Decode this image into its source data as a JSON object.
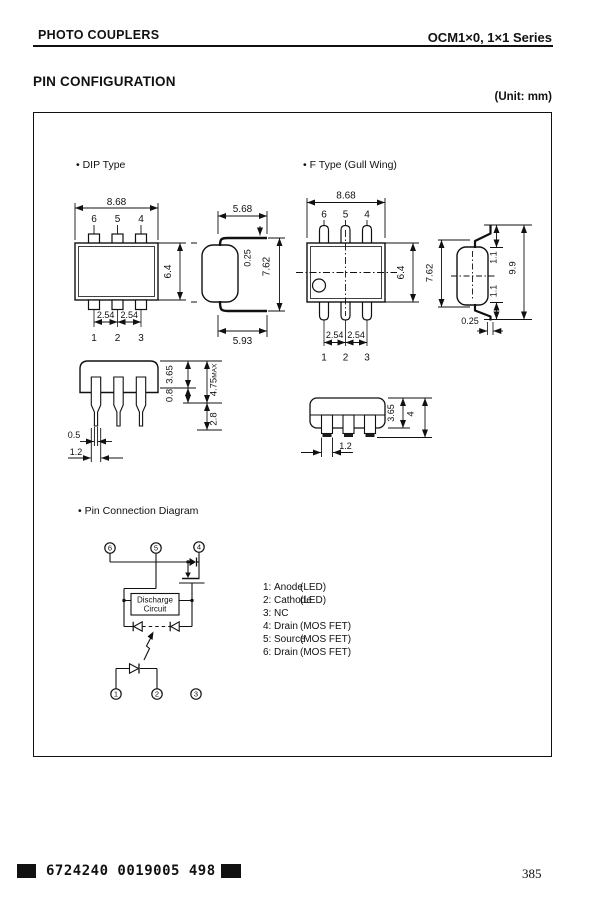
{
  "header": {
    "left": "PHOTO COUPLERS",
    "right": "OCM1×0, 1×1 Series"
  },
  "title": "PIN CONFIGURATION",
  "unit_label": "(Unit: mm)",
  "sections": {
    "dip": "• DIP Type",
    "ftype": "• F Type (Gull Wing)",
    "pin_diagram": "• Pin Connection Diagram"
  },
  "dip": {
    "top": {
      "width": "8.68",
      "height": "6.4",
      "pitch_left": "2.54",
      "pitch_right": "2.54",
      "pins_top": [
        "6",
        "5",
        "4"
      ],
      "pins_bottom": [
        "1",
        "2",
        "3"
      ]
    },
    "side": {
      "top_width": "5.68",
      "lead_thickness": "0.25",
      "height": "7.62",
      "bottom_width": "5.93"
    },
    "front": {
      "body_height": "3.65",
      "shoulder": "0.8",
      "overall": "4.75",
      "overall_suffix": "MAX",
      "lead_length": "2.8",
      "lead_width": "0.5",
      "lead_base_width": "1.2"
    }
  },
  "ftype": {
    "top": {
      "width": "8.68",
      "height": "6.4",
      "pitch_left": "2.54",
      "pitch_right": "2.54",
      "pins_top": [
        "6",
        "5",
        "4"
      ],
      "pins_bottom": [
        "1",
        "2",
        "3"
      ]
    },
    "side": {
      "body_height": "7.62",
      "lead_top": "1.1",
      "lead_bottom": "1.1",
      "overall": "9.9",
      "lead_thickness": "0.25"
    },
    "front": {
      "body_height": "3.65",
      "overall": "4",
      "lead_width": "1.2"
    }
  },
  "diagram": {
    "pins_top": [
      "6",
      "5",
      "4"
    ],
    "pins_bottom": [
      "1",
      "2",
      "3"
    ],
    "box_line1": "Discharge",
    "box_line2": "Circuit"
  },
  "pin_list": [
    {
      "num": "1:",
      "name": "Anode",
      "type": "(LED)"
    },
    {
      "num": "2:",
      "name": "Cathode",
      "type": "(LED)"
    },
    {
      "num": "3:",
      "name": "NC",
      "type": ""
    },
    {
      "num": "4:",
      "name": "Drain",
      "type": "(MOS FET)"
    },
    {
      "num": "5:",
      "name": "Source",
      "type": "(MOS FET)"
    },
    {
      "num": "6:",
      "name": "Drain",
      "type": "(MOS FET)"
    }
  ],
  "footer": {
    "code": "6724240 0019005 498",
    "page": "385"
  }
}
